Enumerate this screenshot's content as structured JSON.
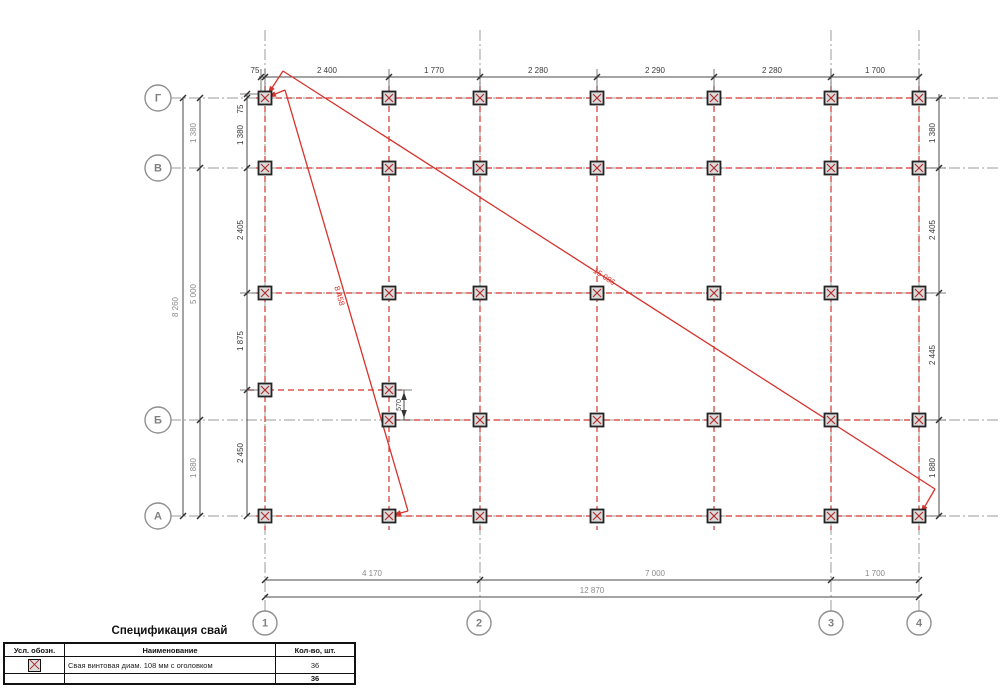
{
  "plan": {
    "axes_left": [
      "Г",
      "В",
      "Б",
      "А"
    ],
    "axes_bottom": [
      "1",
      "2",
      "3",
      "4"
    ],
    "pile_count": 36,
    "colors": {
      "red": "#d6332c",
      "gray_line": "#9b9b9b",
      "dim_line": "#4a4a4a",
      "text_dark": "#3a3a3a",
      "text_gray": "#8a8a8a"
    }
  },
  "spec_table": {
    "title": "Спецификация свай",
    "headers": [
      "Усл. обозн.",
      "Наименование",
      "Кол-во, шт."
    ],
    "rows": [
      {
        "symbol": "pile-symbol",
        "name": "Свая винтовая  диам. 108 мм с оголовком",
        "qty": "36"
      }
    ],
    "total_qty": "36"
  },
  "drawing": {
    "circles": [
      {
        "t": "Г",
        "x": 158,
        "y": 98,
        "r": 13
      },
      {
        "t": "В",
        "x": 158,
        "y": 168,
        "r": 13
      },
      {
        "t": "Б",
        "x": 158,
        "y": 420,
        "r": 13
      },
      {
        "t": "А",
        "x": 158,
        "y": 516,
        "r": 13
      },
      {
        "t": "1",
        "x": 265,
        "y": 623,
        "r": 12
      },
      {
        "t": "2",
        "x": 479,
        "y": 623,
        "r": 12
      },
      {
        "t": "3",
        "x": 831,
        "y": 623,
        "r": 12
      },
      {
        "t": "4",
        "x": 919,
        "y": 623,
        "r": 12
      }
    ],
    "pile_rows": [
      {
        "y": 98,
        "x": [
          265,
          389,
          480,
          597,
          714,
          831,
          919
        ]
      },
      {
        "y": 168,
        "x": [
          265,
          389,
          480,
          597,
          714,
          831,
          919
        ]
      },
      {
        "y": 293,
        "x": [
          265,
          389,
          480,
          597,
          714,
          831,
          919
        ]
      },
      {
        "y": 390,
        "x": [
          265,
          389
        ]
      },
      {
        "y": 420,
        "x": [
          389,
          480,
          597,
          714,
          831,
          919
        ]
      },
      {
        "y": 516,
        "x": [
          265,
          389,
          480,
          597,
          714,
          831,
          919
        ]
      }
    ],
    "red_dash_v": [
      [
        265,
        86,
        265,
        530
      ],
      [
        389,
        86,
        389,
        530
      ],
      [
        480,
        86,
        480,
        530
      ],
      [
        597,
        86,
        597,
        530
      ],
      [
        714,
        86,
        714,
        530
      ],
      [
        831,
        86,
        831,
        530
      ],
      [
        919,
        86,
        919,
        530
      ]
    ],
    "red_dash_h": [
      [
        256,
        98,
        926,
        98
      ],
      [
        256,
        168,
        926,
        168
      ],
      [
        256,
        293,
        926,
        293
      ],
      [
        248,
        390,
        402,
        390
      ],
      [
        384,
        420,
        926,
        420
      ],
      [
        256,
        516,
        926,
        516
      ]
    ],
    "gray_v": [
      [
        265,
        30,
        265,
        611
      ],
      [
        480,
        30,
        480,
        611
      ],
      [
        831,
        30,
        831,
        611
      ],
      [
        919,
        30,
        919,
        611
      ]
    ],
    "gray_h": [
      [
        170,
        98,
        998,
        98
      ],
      [
        170,
        168,
        998,
        168
      ],
      [
        170,
        420,
        998,
        420
      ],
      [
        170,
        516,
        998,
        516
      ],
      [
        252,
        293,
        934,
        293
      ]
    ],
    "dim_lines": [
      [
        259,
        77,
        919,
        77
      ],
      [
        183,
        98,
        183,
        516
      ],
      [
        200,
        98,
        200,
        516
      ],
      [
        247,
        94,
        247,
        516
      ],
      [
        939,
        94,
        939,
        516
      ],
      [
        265,
        580,
        919,
        580
      ],
      [
        265,
        597,
        919,
        597
      ],
      [
        404,
        390,
        404,
        420
      ]
    ],
    "ext_lines": [
      [
        261,
        69,
        261,
        92
      ],
      [
        265,
        69,
        265,
        92
      ],
      [
        389,
        69,
        389,
        92
      ],
      [
        480,
        69,
        480,
        92
      ],
      [
        597,
        69,
        597,
        92
      ],
      [
        714,
        69,
        714,
        92
      ],
      [
        831,
        69,
        831,
        92
      ],
      [
        919,
        69,
        919,
        92
      ],
      [
        240,
        94,
        260,
        94
      ],
      [
        240,
        293,
        258,
        293
      ],
      [
        240,
        390,
        258,
        390
      ],
      [
        924,
        98,
        946,
        98
      ],
      [
        924,
        168,
        946,
        168
      ],
      [
        924,
        293,
        946,
        293
      ],
      [
        924,
        420,
        946,
        420
      ],
      [
        924,
        516,
        946,
        516
      ],
      [
        392,
        390,
        412,
        390
      ],
      [
        392,
        420,
        412,
        420
      ]
    ],
    "red_solid": [
      [
        283,
        71,
        268,
        94
      ],
      [
        283,
        71,
        935,
        489
      ],
      [
        935,
        489,
        921,
        513
      ],
      [
        285,
        90,
        268,
        97
      ],
      [
        285,
        90,
        408,
        511
      ],
      [
        408,
        511,
        393,
        515
      ]
    ],
    "ticks": [
      [
        261,
        77
      ],
      [
        265,
        77
      ],
      [
        389,
        77
      ],
      [
        480,
        77
      ],
      [
        597,
        77
      ],
      [
        714,
        77
      ],
      [
        831,
        77
      ],
      [
        919,
        77
      ],
      [
        183,
        98
      ],
      [
        183,
        516
      ],
      [
        200,
        98
      ],
      [
        200,
        168
      ],
      [
        200,
        420
      ],
      [
        200,
        516
      ],
      [
        247,
        94
      ],
      [
        247,
        98
      ],
      [
        247,
        168
      ],
      [
        247,
        293
      ],
      [
        247,
        390
      ],
      [
        247,
        516
      ],
      [
        939,
        98
      ],
      [
        939,
        168
      ],
      [
        939,
        293
      ],
      [
        939,
        420
      ],
      [
        939,
        516
      ],
      [
        265,
        580
      ],
      [
        480,
        580
      ],
      [
        831,
        580
      ],
      [
        919,
        580
      ],
      [
        265,
        597
      ],
      [
        919,
        597
      ]
    ],
    "arrows": [
      [
        268,
        94,
        123,
        "r"
      ],
      [
        921,
        513,
        120,
        "r"
      ],
      [
        268,
        97,
        158,
        "r"
      ],
      [
        393,
        515,
        165,
        "r"
      ],
      [
        404,
        392,
        -90,
        "d"
      ],
      [
        404,
        418,
        90,
        "d"
      ]
    ],
    "labels": [
      {
        "t": "75",
        "x": 255,
        "y": 71
      },
      {
        "t": "2 400",
        "x": 327,
        "y": 71
      },
      {
        "t": "1 770",
        "x": 434,
        "y": 71
      },
      {
        "t": "2 280",
        "x": 538,
        "y": 71
      },
      {
        "t": "2 290",
        "x": 655,
        "y": 71
      },
      {
        "t": "2 280",
        "x": 772,
        "y": 71
      },
      {
        "t": "1 700",
        "x": 875,
        "y": 71
      },
      {
        "t": "8 260",
        "x": 176,
        "y": 307,
        "r": -90,
        "c": "g"
      },
      {
        "t": "1 380",
        "x": 194,
        "y": 133,
        "r": -90,
        "c": "g"
      },
      {
        "t": "5 000",
        "x": 194,
        "y": 294,
        "r": -90,
        "c": "g"
      },
      {
        "t": "1 880",
        "x": 194,
        "y": 468,
        "r": -90,
        "c": "g"
      },
      {
        "t": "75",
        "x": 241,
        "y": 109,
        "r": -90
      },
      {
        "t": "1 380",
        "x": 241,
        "y": 135,
        "r": -90
      },
      {
        "t": "2 405",
        "x": 241,
        "y": 230,
        "r": -90
      },
      {
        "t": "1 875",
        "x": 241,
        "y": 341,
        "r": -90
      },
      {
        "t": "2 450",
        "x": 241,
        "y": 453,
        "r": -90
      },
      {
        "t": "1 380",
        "x": 933,
        "y": 133,
        "r": -90
      },
      {
        "t": "2 405",
        "x": 933,
        "y": 230,
        "r": -90
      },
      {
        "t": "2 445",
        "x": 933,
        "y": 355,
        "r": -90
      },
      {
        "t": "1 880",
        "x": 933,
        "y": 468,
        "r": -90
      },
      {
        "t": "4 170",
        "x": 372,
        "y": 574,
        "c": "g"
      },
      {
        "t": "7 000",
        "x": 655,
        "y": 574,
        "c": "g"
      },
      {
        "t": "1 700",
        "x": 875,
        "y": 574,
        "c": "g"
      },
      {
        "t": "12 870",
        "x": 592,
        "y": 591,
        "c": "g"
      },
      {
        "t": "8 458",
        "x": 339,
        "y": 296,
        "r": 74,
        "c": "r"
      },
      {
        "t": "15 086",
        "x": 604,
        "y": 277,
        "r": 33,
        "c": "r"
      },
      {
        "t": "570",
        "x": 399,
        "y": 405,
        "r": -90,
        "s": 7
      }
    ]
  }
}
